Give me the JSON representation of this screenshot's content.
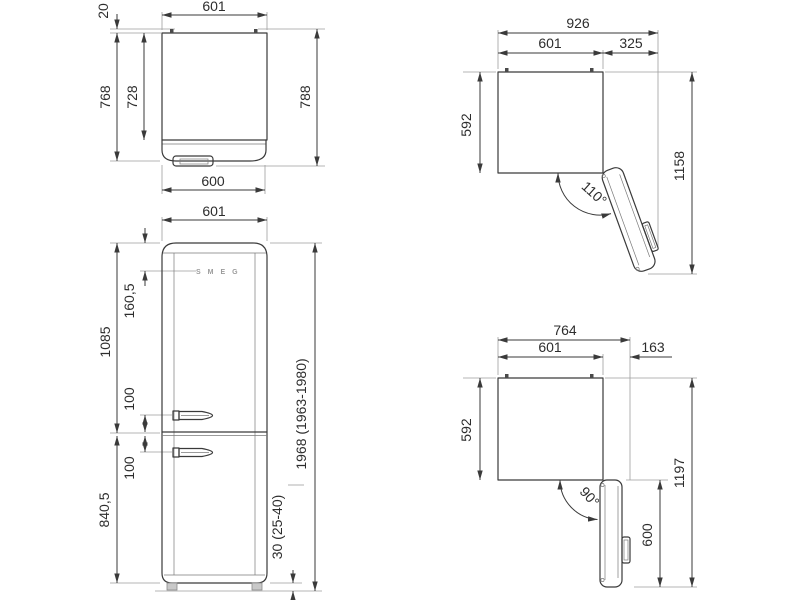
{
  "meta": {
    "title": "Refrigerator dimensional drawing",
    "units": "mm"
  },
  "colors": {
    "outline": "#3a3a3a",
    "extension": "#9e9e9e",
    "text": "#2d2d2d",
    "logo": "#9b9b9b"
  },
  "views": {
    "top": {
      "dims": {
        "width_top": "601",
        "rear_gap": "20",
        "depth_with_door": "768",
        "depth_body": "728",
        "depth_overall": "788",
        "width_door": "600"
      }
    },
    "front": {
      "logo": "SMEG",
      "dims": {
        "width": "601",
        "logo_from_top": "160,5",
        "upper_section": "1085",
        "upper_handle": "100",
        "lower_handle": "100",
        "lower_section": "840,5",
        "overall_height": "1968 (1963-1980)",
        "feet_height": "30 (25-40)"
      }
    },
    "open110": {
      "dims": {
        "overall_width": "926",
        "body_width": "601",
        "door_side": "325",
        "body_depth": "592",
        "angle": "110°",
        "overall_depth": "1158"
      }
    },
    "open90": {
      "dims": {
        "overall_width": "764",
        "body_width": "601",
        "door_side": "163",
        "body_depth": "592",
        "angle": "90°",
        "door_reach": "600",
        "overall_depth": "1197"
      }
    }
  }
}
